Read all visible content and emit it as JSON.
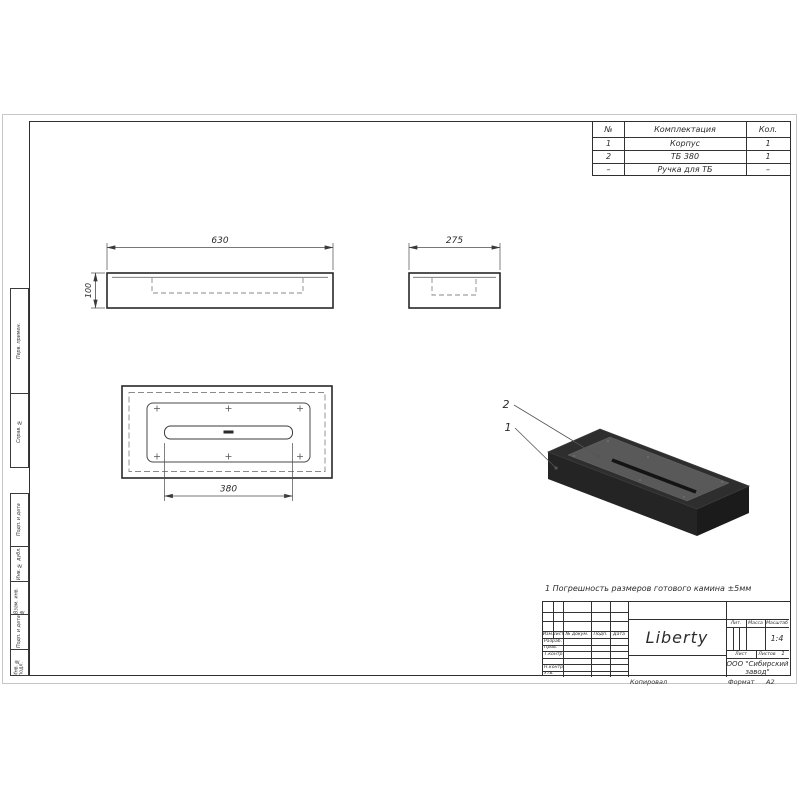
{
  "drawing": {
    "dims": {
      "width": "630",
      "height": "100",
      "depth": "275",
      "burner": "380"
    },
    "callouts": {
      "body": "1",
      "burner": "2"
    }
  },
  "parts_table": {
    "headers": {
      "num": "№",
      "name": "Комплектация",
      "qty": "Кол."
    },
    "rows": [
      {
        "num": "1",
        "name": "Корпус",
        "qty": "1"
      },
      {
        "num": "2",
        "name": "ТБ 380",
        "qty": "1"
      },
      {
        "num": "–",
        "name": "Ручка для ТБ",
        "qty": "–"
      }
    ]
  },
  "note": "1 Погрешность размеров готового камина ±5мм",
  "title_block": {
    "name": "Liberty",
    "lit_label": "Лит.",
    "mass_label": "Масса",
    "scale_label": "Масштаб",
    "scale_value": "1:4",
    "sheet_label": "Лист",
    "sheets_label": "Листов",
    "sheets_value": "1",
    "company_line1": "ООО \"Сибирский",
    "company_line2": "завод\"",
    "cols": {
      "izm": "Изм.",
      "list": "Лист",
      "doc": "№ докум.",
      "sign": "Подп.",
      "date": "Дата"
    },
    "rows": {
      "dev": "Разраб.",
      "check": "Пров.",
      "tcontr": "Т.контр.",
      "ncontr": "Н.контр.",
      "approve": "Утв."
    },
    "copied_label": "Копировал",
    "format_label": "Формат",
    "format_value": "А2"
  },
  "side_stamps": {
    "perv": "Перв. примен.",
    "sprav": "Справ. №",
    "podp1": "Подп. и дата",
    "inv_dubl": "Инв. № дубл.",
    "vzam": "Взам. инв. №",
    "podp2": "Подп. и дата",
    "inv_podl": "Инв. № подл."
  }
}
